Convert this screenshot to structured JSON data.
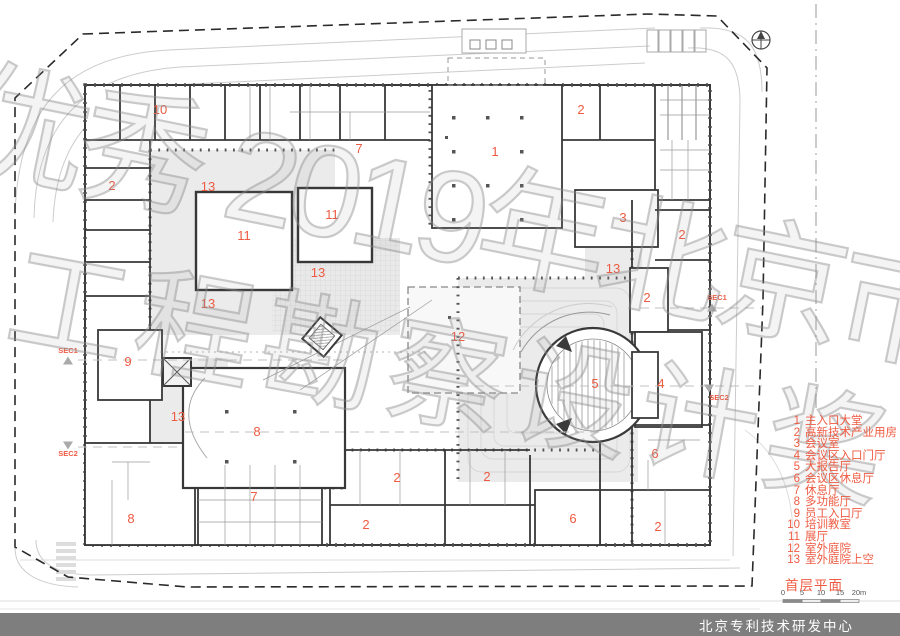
{
  "colors": {
    "accent": "#ee5b42",
    "titlebar_bg": "#7e7e7e",
    "titlebar_text": "#ffffff",
    "wall": "#383838",
    "courtyard_gray": "#ebebeb",
    "watermark_gray": "#999999"
  },
  "watermark": {
    "line1": "优秀 2019年北京市",
    "line2": "工程勘察设计奖"
  },
  "legend": {
    "items": [
      {
        "num": "1",
        "label": "主入口大堂"
      },
      {
        "num": "2",
        "label": "高新技术产业用房"
      },
      {
        "num": "3",
        "label": "会议室"
      },
      {
        "num": "4",
        "label": "会议区入口门厅"
      },
      {
        "num": "5",
        "label": "大报告厅"
      },
      {
        "num": "6",
        "label": "会议区休息厅"
      },
      {
        "num": "7",
        "label": "休息厅"
      },
      {
        "num": "8",
        "label": "多功能厅"
      },
      {
        "num": "9",
        "label": "员工入口厅"
      },
      {
        "num": "10",
        "label": "培训教室"
      },
      {
        "num": "11",
        "label": "展厅"
      },
      {
        "num": "12",
        "label": "室外庭院"
      },
      {
        "num": "13",
        "label": "室外庭院上空"
      }
    ],
    "plan_title": "首层平面"
  },
  "scale_bar": {
    "ticks": [
      "0",
      "5",
      "10",
      "15",
      "20m"
    ]
  },
  "footer": {
    "title": "北京专利技术研发中心"
  },
  "plan": {
    "room_labels": [
      {
        "t": "10",
        "x": 160,
        "y": 110
      },
      {
        "t": "2",
        "x": 112,
        "y": 186
      },
      {
        "t": "7",
        "x": 359,
        "y": 149
      },
      {
        "t": "1",
        "x": 495,
        "y": 152
      },
      {
        "t": "2",
        "x": 581,
        "y": 110
      },
      {
        "t": "13",
        "x": 208,
        "y": 187
      },
      {
        "t": "11",
        "x": 332,
        "y": 215
      },
      {
        "t": "11",
        "x": 244,
        "y": 236
      },
      {
        "t": "3",
        "x": 623,
        "y": 218
      },
      {
        "t": "2",
        "x": 682,
        "y": 235
      },
      {
        "t": "13",
        "x": 613,
        "y": 269
      },
      {
        "t": "13",
        "x": 318,
        "y": 273
      },
      {
        "t": "2",
        "x": 647,
        "y": 298
      },
      {
        "t": "13",
        "x": 208,
        "y": 304
      },
      {
        "t": "9",
        "x": 128,
        "y": 362
      },
      {
        "t": "12",
        "x": 458,
        "y": 337
      },
      {
        "t": "5",
        "x": 595,
        "y": 384
      },
      {
        "t": "4",
        "x": 661,
        "y": 384
      },
      {
        "t": "13",
        "x": 178,
        "y": 417
      },
      {
        "t": "8",
        "x": 257,
        "y": 432
      },
      {
        "t": "2",
        "x": 397,
        "y": 478
      },
      {
        "t": "2",
        "x": 487,
        "y": 477
      },
      {
        "t": "6",
        "x": 655,
        "y": 454
      },
      {
        "t": "7",
        "x": 254,
        "y": 497
      },
      {
        "t": "8",
        "x": 131,
        "y": 519
      },
      {
        "t": "2",
        "x": 366,
        "y": 525
      },
      {
        "t": "6",
        "x": 573,
        "y": 519
      },
      {
        "t": "2",
        "x": 658,
        "y": 527
      }
    ],
    "section_markers": [
      {
        "label": "SEC1",
        "x": 68,
        "y": 353,
        "dir": "up",
        "tx": 68,
        "ty": 361
      },
      {
        "label": "SEC2",
        "x": 68,
        "y": 456,
        "dir": "down",
        "tx": 68,
        "ty": 445
      },
      {
        "label": "SEC1",
        "x": 717,
        "y": 300,
        "dir": "up",
        "tx": 712,
        "ty": 308
      },
      {
        "label": "SEC2",
        "x": 719,
        "y": 400,
        "dir": "down",
        "tx": 709,
        "ty": 388
      }
    ]
  }
}
